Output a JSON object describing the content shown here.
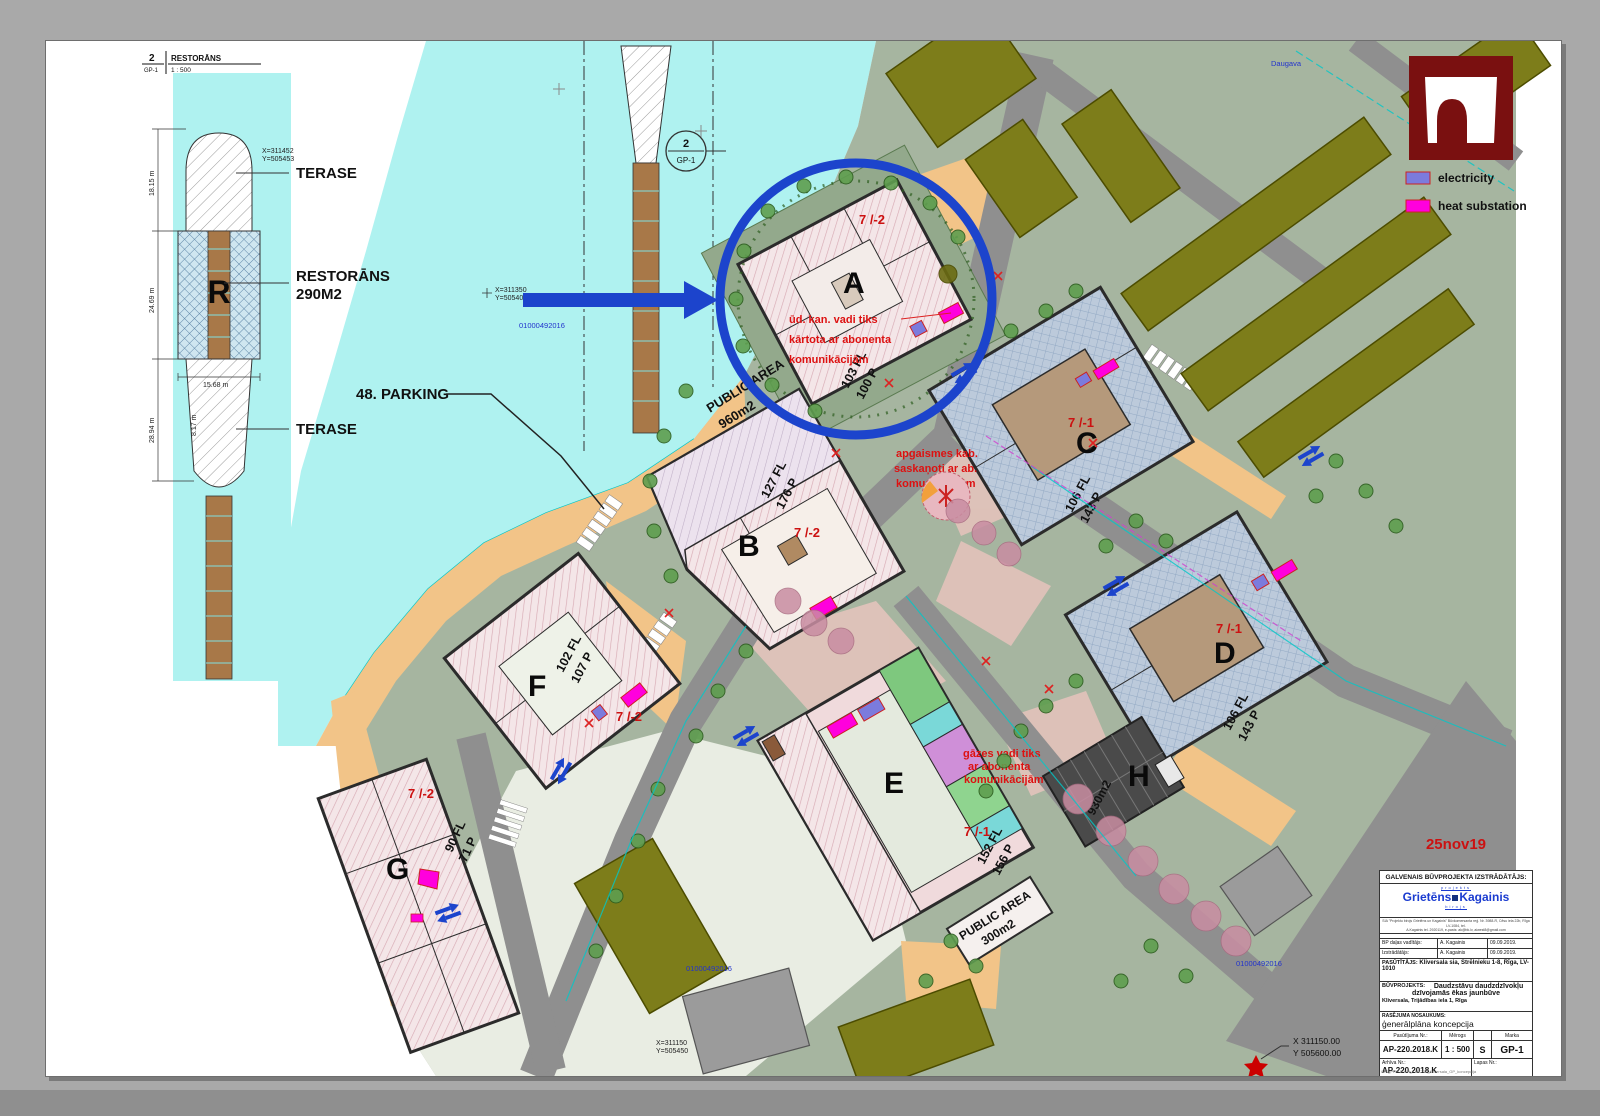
{
  "date_stamp": "25nov19",
  "colors": {
    "highlight_blue": "#1c44cc",
    "electricity": "#7b7bdd",
    "heat_substation": "#ff00dd",
    "logo_red": "#7a1010"
  },
  "detail_callout": {
    "number": "2",
    "sheet": "GP-1",
    "title": "RESTORĀNS",
    "scale": "1 : 500"
  },
  "detail": {
    "r_label": "R",
    "terase_top": "TERASE",
    "restorans_line1": "RESTORĀNS",
    "restorans_line2": "290M2",
    "terase_bottom": "TERASE",
    "dim_top": "18.15 m",
    "dim_mid": "24.69 m",
    "dim_low": "28.94 m",
    "dim_width": "15.68 m",
    "dim_small": "8.17 m",
    "coord_x": "X=311452",
    "coord_y": "Y=505453"
  },
  "legend": {
    "electricity_label": "electricity",
    "heat_label": "heat substation"
  },
  "plan": {
    "parking_callout": "48. PARKING",
    "section_marker": {
      "number": "2",
      "sheet": "GP-1"
    },
    "river_label": "Daugava",
    "coord_a_x": "X=311350",
    "coord_a_y": "Y=505400",
    "cadastre": "01000492016",
    "coord_b_x": "X=311150",
    "coord_b_y": "Y=505450",
    "corner_coord_x": "X 311150.00",
    "corner_coord_y": "Y 505600.00",
    "buildings": [
      {
        "letter": "A",
        "zone": "7 /-2",
        "floors": "103 FL",
        "parking": "100 P"
      },
      {
        "letter": "B",
        "zone": "7 /-2",
        "floors": "127 FL",
        "parking": "176 P",
        "public_area": "PUBLIC AREA",
        "public_area_size": "960m2"
      },
      {
        "letter": "C",
        "zone": "7 /-1",
        "floors": "106 FL",
        "parking": "143 P"
      },
      {
        "letter": "D",
        "zone": "7 /-1",
        "floors": "106 FL",
        "parking": "143 P"
      },
      {
        "letter": "E",
        "zone": "7 /-1",
        "floors": "152 FL",
        "parking": "156 P",
        "public_area": "PUBLIC AREA",
        "public_area_size": "300m2"
      },
      {
        "letter": "F",
        "zone": "7 /-2",
        "floors": "102 FL",
        "parking": "107 P"
      },
      {
        "letter": "G",
        "zone": "7 /-2",
        "floors": "90 FL",
        "parking": "71 P"
      },
      {
        "letter": "H",
        "area": "930m2"
      }
    ],
    "notes": {
      "a": {
        "l1": "ūd. kan. vadi tiks",
        "l2": "kārtota ar abonenta",
        "l3": "komunikācijām"
      },
      "c": {
        "l1": "apgaismes kab.",
        "l2": "saskaņoti ar ab.",
        "l3": "komunikācijām"
      },
      "e": {
        "l1": "gāzes vadi tiks",
        "l2": "ar abonenta",
        "l3": "komunikācijām"
      }
    }
  },
  "titleblock": {
    "header": "GALVENAIS BŪVPROJEKTA IZSTRĀDĀTĀJS:",
    "logo_top": "projekts",
    "logo_name1": "Grietēns",
    "logo_name2": "Kagainis",
    "logo_bottom": "birojs",
    "fineprint1": "SIA \"Projektu birojs Grietēns un Kagainis\" Būvkomersanta reģ. Nr. 3988-R, Cēsu iela 22b, Rīga LV-1084, tel.",
    "fineprint2": "A.Kagainis tel. 2920119, e-pasts: ak@bk.lv, aiwest8@gmail.com",
    "row1_label": "BP daļas vadītājs:",
    "row1_name": "A. Kagainis",
    "row1_date": "09.09.2019.",
    "row2_label": "Izstrādātājs:",
    "row2_name": "A. Kagainis",
    "row2_date": "09.09.2019.",
    "client_label": "PASŪTĪTĀJS:",
    "client": "Kliversala sia, Strēlnieku 1-8, Rīga, LV-1010",
    "project_label": "BŪVPROJEKTS:",
    "project_line1": "Daudzstāvu daudzdzīvokļu",
    "project_line2": "dzīvojamās ēkas jaunbūve",
    "project_line3": "Kliversala, Trijādības iela 1, Rīga",
    "drawing_label": "RASĒJUMA NOSAUKUMS:",
    "drawing_name": "ģenerālplāna koncepcija",
    "order_label": "Pasūtījuma Nr.:",
    "order_value": "AP-220.2018.K",
    "scale_label": "Mērogs",
    "scale_value": "1 : 500",
    "stage_value": "S",
    "marka_label": "Marka",
    "marka_value": "GP-1",
    "archive_label": "Arhīva Nr.:",
    "archive_value": "AP-220.2018.K",
    "page_label": "Lapas Nr.:",
    "footer_path": "GrK_PROJEKTI_KMK220_Kliversala_GP_koncepcija"
  }
}
